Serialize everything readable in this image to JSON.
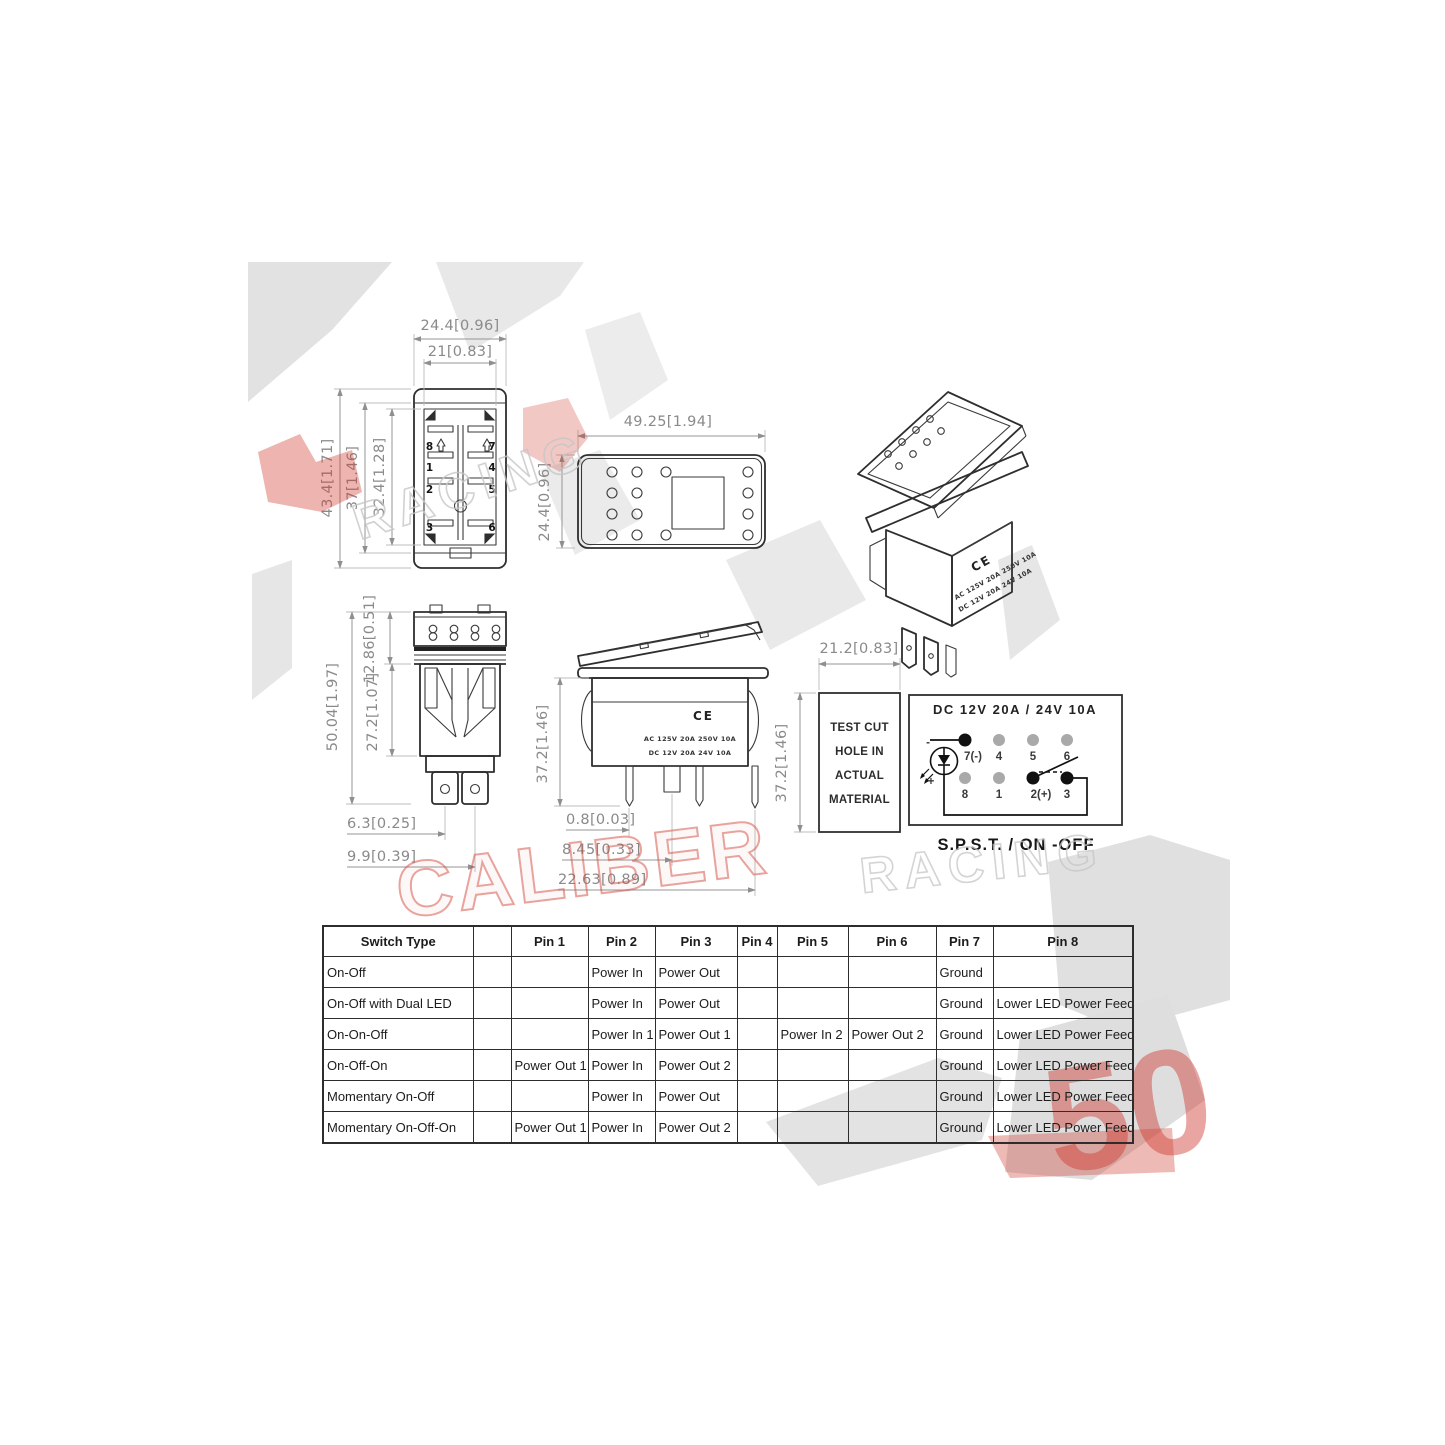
{
  "watermark": {
    "fifty": "50",
    "caliber": "CALIBER",
    "racing": "RACING"
  },
  "product_marking": {
    "ac": "AC 125V 20A 250V 10A",
    "dc": "DC 12V 20A 24V 10A",
    "ce": "CE"
  },
  "front": {
    "dim_width": "24.4[0.96]",
    "dim_inner_width": "21[0.83]",
    "dim_height": "43.4[1.71]",
    "dim_mid_height": "37[1.46]",
    "dim_inner_height": "32.4[1.28]",
    "pin_8": "8",
    "pin_7": "7",
    "pin_1": "1",
    "pin_4": "4",
    "pin_2": "2",
    "pin_5": "5",
    "pin_3": "3",
    "pin_6": "6"
  },
  "panel": {
    "dim_width": "49.25[1.94]",
    "dim_height": "24.4[0.96]"
  },
  "bottom": {
    "dim_terminal": "12.86[0.51]",
    "dim_total": "50.04[1.97]",
    "dim_body": "27.2[1.07]",
    "dim_lug1": "6.3[0.25]",
    "dim_lug2": "9.9[0.39]"
  },
  "side": {
    "dim_height": "37.2[1.46]",
    "dim_pin1": "0.8[0.03]",
    "dim_pin2": "8.45[0.33]",
    "dim_pin3": "22.63[0.89]"
  },
  "testcut": {
    "line1": "TEST CUT",
    "line2": "HOLE IN",
    "line3": "ACTUAL",
    "line4": "MATERIAL",
    "dim_width": "21.2[0.83]",
    "dim_height": "37.2[1.46]"
  },
  "wiring": {
    "title": "DC  12V  20A  /  24V  10A",
    "spst_label": "S.P.S.T. /  ON -OFF",
    "minus": "-",
    "plus": "+",
    "p7": "7(-)",
    "p4": "4",
    "p5": "5",
    "p6": "6",
    "p8": "8",
    "p1": "1",
    "p2": "2(+)",
    "p3": "3"
  },
  "table": {
    "headers": [
      "Switch Type",
      "",
      "Pin 1",
      "Pin 2",
      "Pin 3",
      "Pin 4",
      "Pin 5",
      "Pin 6",
      "Pin 7",
      "Pin 8"
    ],
    "rows": [
      [
        "On-Off",
        "",
        "",
        "Power In",
        "Power Out",
        "",
        "",
        "",
        "Ground",
        ""
      ],
      [
        "On-Off with Dual LED",
        "",
        "",
        "Power In",
        "Power Out",
        "",
        "",
        "",
        "Ground",
        "Lower LED Power Feed"
      ],
      [
        "On-On-Off",
        "",
        "",
        "Power In 1",
        "Power Out 1",
        "",
        "Power In 2",
        "Power Out 2",
        "Ground",
        "Lower LED Power Feed"
      ],
      [
        "On-Off-On",
        "",
        "Power Out 1",
        "Power In",
        "Power Out 2",
        "",
        "",
        "",
        "Ground",
        "Lower LED Power Feed"
      ],
      [
        "Momentary On-Off",
        "",
        "",
        "Power In",
        "Power Out",
        "",
        "",
        "",
        "Ground",
        "Lower LED Power Feed"
      ],
      [
        "Momentary On-Off-On",
        "",
        "Power Out 1",
        "Power In",
        "Power Out 2",
        "",
        "",
        "",
        "Ground",
        "Lower LED Power Feed"
      ]
    ]
  }
}
